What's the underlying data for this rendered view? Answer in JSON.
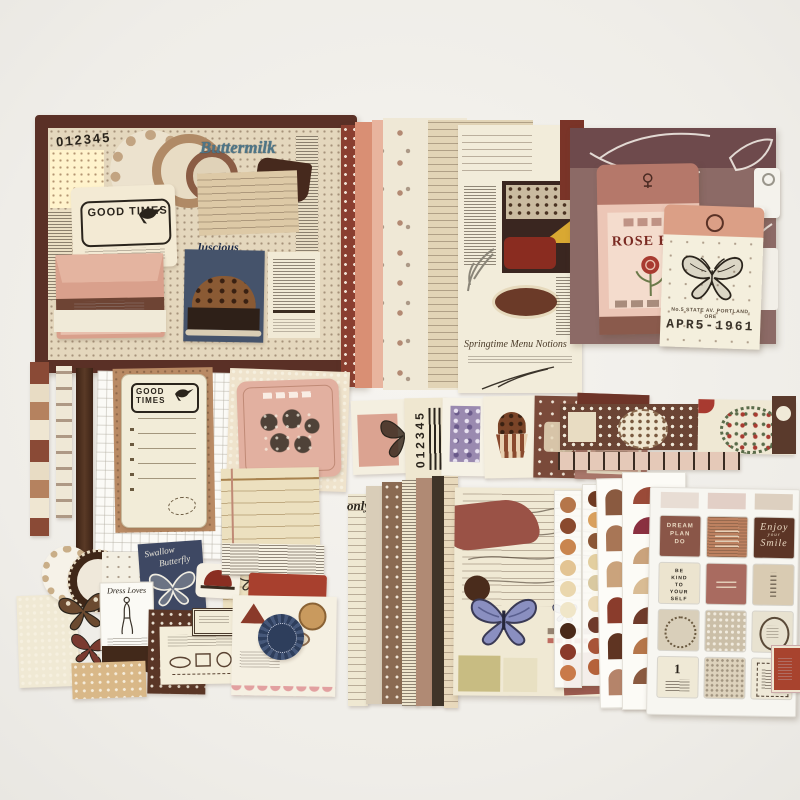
{
  "product": {
    "description": "Flat-lay product photo of a vintage scrapbooking / junk-journal ephemera kit with wooden box, paper packs, envelopes, tickets, washi tape and sticker sheets"
  },
  "box": {
    "brand_title": "Buttermilk",
    "digits_sheet": "012345",
    "good_times_card": "GOOD TIMES",
    "magazine_word": "luscious"
  },
  "checklist_ticket": {
    "header": "GOOD TIMES"
  },
  "ticket_fan": {
    "digits": "012345"
  },
  "rose_envelope": {
    "title": "ROSE B"
  },
  "seed_packet": {
    "address_line": "No.5 STATE AV. PORTLAND. ORE",
    "date_stamp": "APR5-1961"
  },
  "navy_tag": {
    "script_line1": "Swallow",
    "script_line2": "Butterfly"
  },
  "lady_card": {
    "title": "Dress Loves"
  },
  "card_stack": {
    "visible_word": "only"
  },
  "magazine_page": {
    "script_caption": "Springtime Menu Notions"
  },
  "sticker_sheet": {
    "dream_lines": [
      "DREAM",
      "PLAN",
      "DO"
    ],
    "enjoy_lines": [
      "Enjoy",
      "your",
      "Smile"
    ],
    "be_kind_lines": [
      "BE",
      "KIND",
      "TO",
      "YOUR",
      "SELF"
    ],
    "number_label": "1"
  },
  "palette": {
    "background": "#f1efeb",
    "box_frame": "#5a3026",
    "navy": "#3e4863",
    "maroon": "#7a3a2c",
    "salmon": "#d99b84",
    "cream": "#f0e9d6",
    "dark_brown": "#4a2d1f",
    "terracotta": "#bd8160",
    "mauve_paper": "#8c6a66",
    "butterfly_blue": "#8a8fc0"
  }
}
